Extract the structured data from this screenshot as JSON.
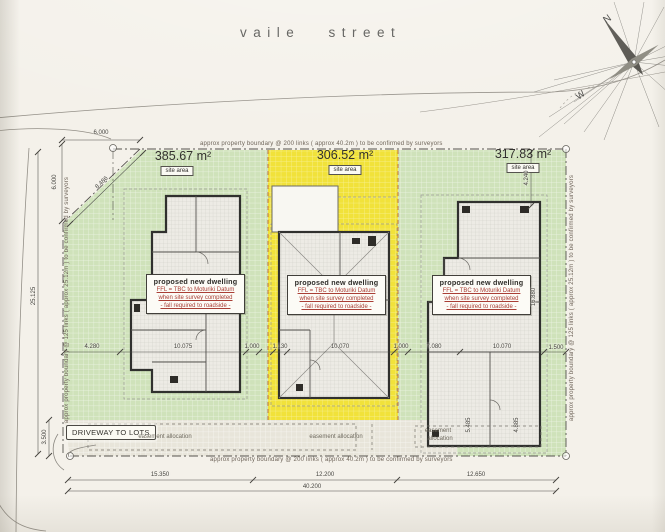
{
  "street": {
    "name": "vaile street"
  },
  "compass": {
    "north": "N",
    "west": "W"
  },
  "boundary": {
    "top": "approx property boundary @ 200 links ( approx 40.2m ) to be confirmed by surveyors",
    "bottom": "approx property boundary @ 200 links ( approx 40.2m ) to be confirmed by surveyors",
    "left": "approx property boundary @ 125 links ( approx 25.12m ) to be confirmed by surveyors",
    "right": "approx property boundary @ 125 links ( approx 25.12m ) to be confirmed by surveyors"
  },
  "lots": [
    {
      "site_area": "385.67 m²",
      "tag": "site area"
    },
    {
      "site_area": "306.52 m²",
      "tag": "site area"
    },
    {
      "site_area": "317.83 m²",
      "tag": "site area"
    }
  ],
  "dwelling": {
    "title": "proposed new dwelling",
    "note1": "FFL = TBC to Moturiki Datum",
    "note2": "when site survey completed",
    "note3": "- fall required to roadside -"
  },
  "driveway": {
    "label": "DRIVEWAY TO LOTS"
  },
  "easement": {
    "left": "easement allocation",
    "middle": "easement allocation",
    "right_line1": "easement",
    "right_line2": "allocation"
  },
  "dims": {
    "street_offset": "6.000",
    "left_offset": "6.000",
    "splay": "8.486",
    "left_depth": "25.125",
    "driveway_depth": "3.500",
    "mid_row": {
      "d1": "4.280",
      "d2": "10.075",
      "d3": "1.000",
      "d4": "1.130",
      "d5": "10.070",
      "d6": "1.000",
      "d7": "7.080",
      "d8": "10.070",
      "d9": "1.500"
    },
    "lot3_top": "4.240",
    "lot3_house": "16.880",
    "lot3_e1": "5.485",
    "lot3_e2": "4.885",
    "bottom_lot1": "15.350",
    "bottom_lot2": "12.200",
    "bottom_lot3": "12.650",
    "bottom_total": "40.200"
  },
  "colors": {
    "lot_green": "#cfe2ba",
    "lot_yellow": "#f1e23a",
    "house_fill": "#edebe5",
    "red_note": "#a93e35",
    "paper": "#f4f1ea"
  }
}
